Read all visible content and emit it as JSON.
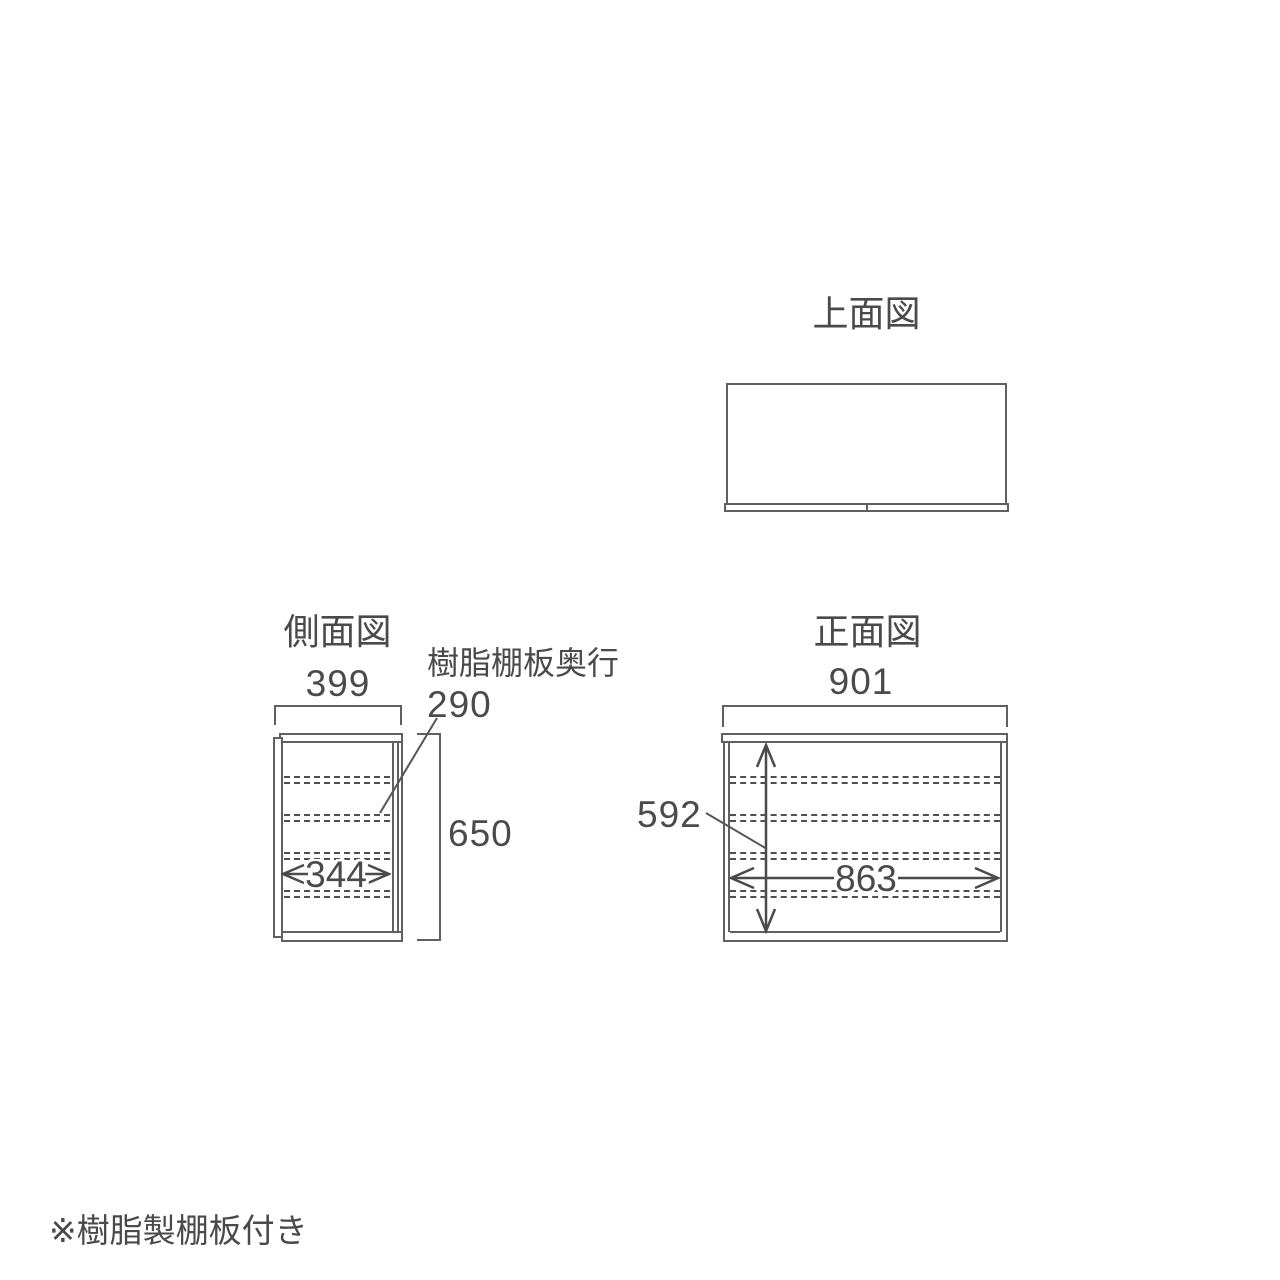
{
  "footnote": "※樹脂製棚板付き",
  "colors": {
    "line": "#606060",
    "text": "#4a4a4a",
    "dashed_shelf": "#4f4f4f",
    "background": "#ffffff"
  },
  "views": {
    "top": {
      "title": "上面図"
    },
    "side": {
      "title": "側面図",
      "outer_width": "399",
      "inner_width": "344",
      "height": "650",
      "shelf_depth_label": "樹脂棚板奥行",
      "shelf_depth_value": "290"
    },
    "front": {
      "title": "正面図",
      "outer_width": "901",
      "inner_width": "863",
      "inner_height": "592"
    }
  }
}
